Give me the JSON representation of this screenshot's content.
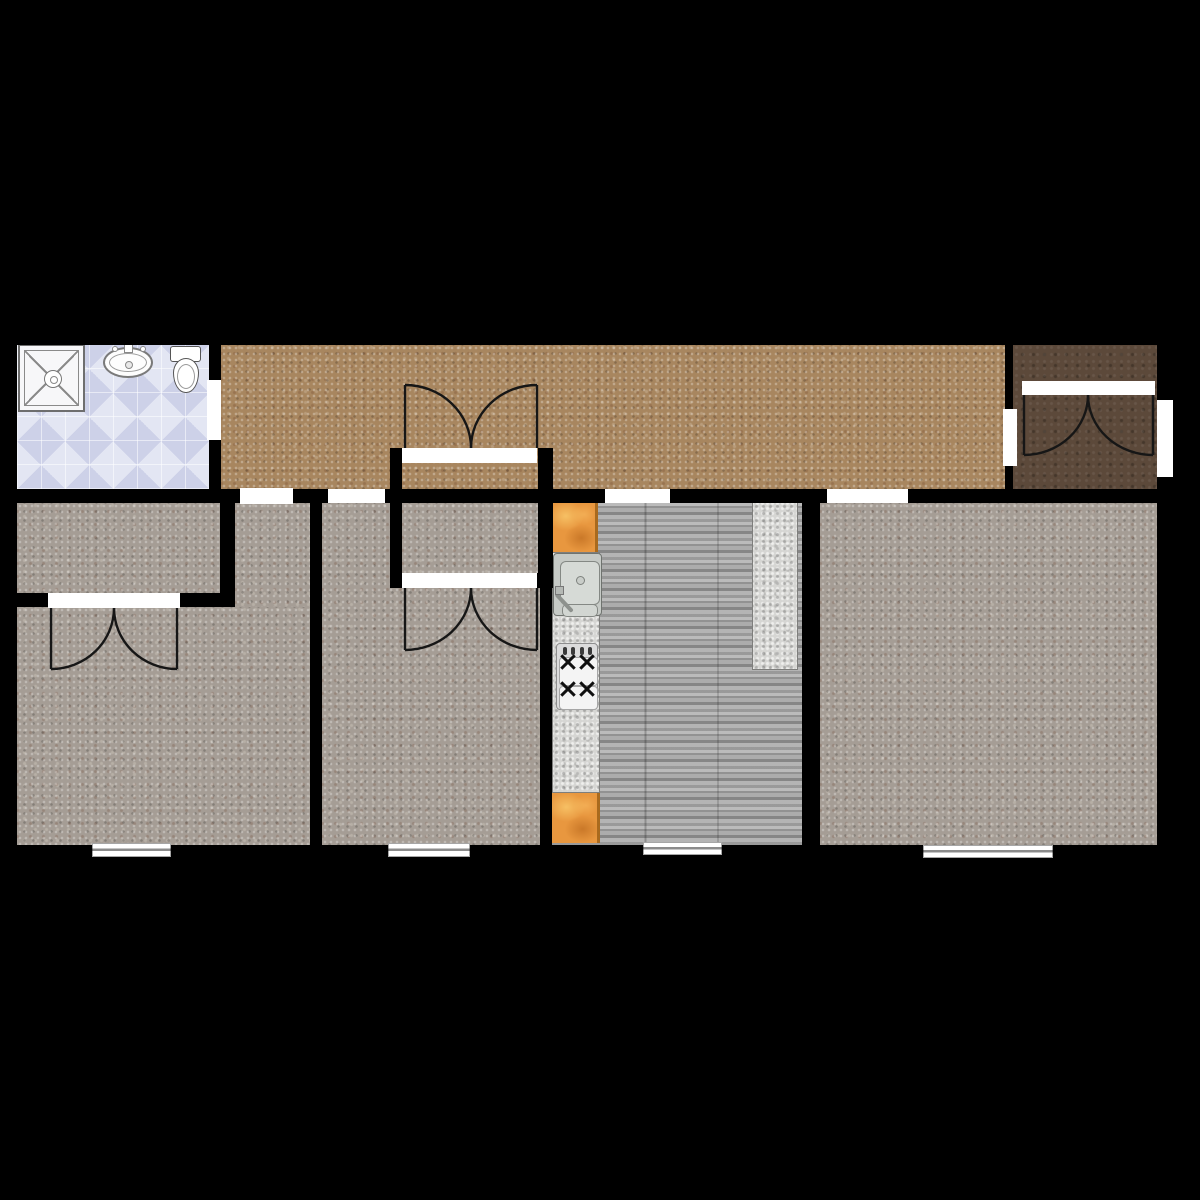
{
  "meta": {
    "canvas_width": 1200,
    "canvas_height": 1200,
    "background": "#000000",
    "kind": "residential-floor-plan"
  },
  "palette": {
    "wall": "#000000",
    "opening": "#ffffff",
    "carpet_brown": "#a8865f",
    "carpet_gray": "#a59d95",
    "carpet_dark_brown": "#5c493a",
    "bathroom_tile": "#d6daee",
    "kitchen_plank": "#a3a3a3",
    "granite": "#d6d6d3",
    "cutting_board": "#e8973f",
    "door_arc": "#161616"
  },
  "rooms": [
    {
      "name": "bathroom-floor",
      "tex": "tile",
      "color": "#d6daee",
      "rect": [
        17,
        345,
        192,
        144
      ]
    },
    {
      "name": "hallway-floor",
      "tex": "carpet",
      "color": "#a8865f",
      "rect": [
        221,
        345,
        784,
        144
      ]
    },
    {
      "name": "entry-room-floor",
      "tex": "dark",
      "color": "#5c493a",
      "rect": [
        1013,
        344,
        147,
        149
      ]
    },
    {
      "name": "left-closet-floor",
      "tex": "carpet",
      "color": "#a59d95",
      "rect": [
        17,
        503,
        203,
        90
      ]
    },
    {
      "name": "left-bedroom-alcove-floor",
      "tex": "carpet",
      "color": "#a59d95",
      "rect": [
        235,
        503,
        75,
        110
      ]
    },
    {
      "name": "left-bedroom-floor",
      "tex": "carpet",
      "color": "#a59d95",
      "rect": [
        17,
        607,
        293,
        238
      ]
    },
    {
      "name": "center-bedroom-floor",
      "tex": "carpet",
      "color": "#a59d95",
      "rect": [
        322,
        503,
        218,
        342
      ]
    },
    {
      "name": "hall-closet-floor",
      "tex": "carpet",
      "color": "#a59d95",
      "rect": [
        402,
        503,
        136,
        70
      ]
    },
    {
      "name": "kitchen-floor",
      "tex": "plank",
      "color": "#a3a3a3",
      "rect": [
        552,
        503,
        250,
        342
      ]
    },
    {
      "name": "living-room-floor",
      "tex": "carpet",
      "color": "#a59d95",
      "rect": [
        820,
        503,
        337,
        342
      ]
    }
  ],
  "walls": [
    {
      "name": "exterior-wall-top",
      "rect": [
        10,
        330,
        1162,
        15
      ]
    },
    {
      "name": "exterior-wall-left",
      "rect": [
        10,
        330,
        7,
        528
      ]
    },
    {
      "name": "exterior-wall-bottom",
      "rect": [
        10,
        845,
        1162,
        13
      ]
    },
    {
      "name": "exterior-wall-right",
      "rect": [
        1157,
        330,
        15,
        528
      ]
    },
    {
      "name": "hallway-south-wall",
      "rect": [
        15,
        489,
        1157,
        14
      ]
    },
    {
      "name": "bathroom-east-wall",
      "rect": [
        209,
        345,
        12,
        144
      ]
    },
    {
      "name": "entry-west-wall",
      "rect": [
        1005,
        344,
        8,
        146
      ]
    },
    {
      "name": "left-closet-east-wall",
      "rect": [
        220,
        503,
        15,
        104
      ]
    },
    {
      "name": "left-closet-south-wall",
      "rect": [
        15,
        593,
        220,
        14
      ]
    },
    {
      "name": "center-bedroom-west-wall",
      "rect": [
        310,
        503,
        12,
        342
      ]
    },
    {
      "name": "hall-closet-west-wall",
      "rect": [
        390,
        448,
        12,
        140
      ]
    },
    {
      "name": "hall-closet-east-wall",
      "rect": [
        538,
        448,
        15,
        140
      ]
    },
    {
      "name": "hall-closet-south-wall",
      "rect": [
        390,
        573,
        163,
        15
      ]
    },
    {
      "name": "kitchen-west-wall",
      "rect": [
        540,
        588,
        12,
        257
      ]
    },
    {
      "name": "kitchen-east-wall",
      "rect": [
        802,
        503,
        18,
        342
      ]
    }
  ],
  "openings": [
    {
      "name": "bathroom-door-opening",
      "rect": [
        207,
        380,
        14,
        60
      ]
    },
    {
      "name": "left-bedroom-opening",
      "rect": [
        240,
        488,
        53,
        16
      ]
    },
    {
      "name": "center-bedroom-opening",
      "rect": [
        328,
        489,
        57,
        14
      ]
    },
    {
      "name": "kitchen-opening",
      "rect": [
        605,
        489,
        65,
        14
      ]
    },
    {
      "name": "living-room-opening",
      "rect": [
        827,
        489,
        81,
        14
      ]
    },
    {
      "name": "entry-opening-west",
      "rect": [
        1003,
        409,
        14,
        57
      ]
    },
    {
      "name": "entry-exterior-door-opening",
      "rect": [
        1157,
        400,
        16,
        77
      ]
    },
    {
      "name": "hall-closet-north-doorway",
      "rect": [
        402,
        448,
        135,
        15
      ]
    },
    {
      "name": "hall-closet-south-doorway",
      "rect": [
        402,
        573,
        135,
        15
      ]
    },
    {
      "name": "left-closet-doorway",
      "rect": [
        48,
        593,
        132,
        15
      ]
    },
    {
      "name": "entry-closet-doorway",
      "rect": [
        1022,
        381,
        133,
        14
      ]
    }
  ],
  "windows": [
    {
      "name": "left-bedroom-window",
      "rect": [
        92,
        843,
        79,
        14
      ]
    },
    {
      "name": "center-bedroom-window",
      "rect": [
        388,
        843,
        82,
        14
      ]
    },
    {
      "name": "kitchen-window",
      "rect": [
        643,
        842,
        79,
        13
      ]
    },
    {
      "name": "living-room-window",
      "rect": [
        923,
        845,
        130,
        13
      ]
    }
  ],
  "doors": [
    {
      "name": "hall-closet-north-door-left",
      "path": "M405,385 L405,448 M471,448 A66,63 0 0 0 405,385"
    },
    {
      "name": "hall-closet-north-door-right",
      "path": "M537,385 L537,448 M471,448 A66,63 0 0 1 537,385"
    },
    {
      "name": "hall-closet-south-door-left",
      "path": "M405,650 L405,588 M471,588 A66,62 0 0 1 405,650"
    },
    {
      "name": "hall-closet-south-door-right",
      "path": "M537,650 L537,588 M471,588 A66,62 0 0 0 537,650"
    },
    {
      "name": "left-closet-door-left",
      "path": "M51,669 L51,608 M114,608 A63,61 0 0 1 51,669"
    },
    {
      "name": "left-closet-door-right",
      "path": "M177,669 L177,608 M114,608 A63,61 0 0 0 177,669"
    },
    {
      "name": "entry-closet-door-left",
      "path": "M1024,455 L1024,395 M1088,395 A64,60 0 0 1 1024,455"
    },
    {
      "name": "entry-closet-door-right",
      "path": "M1153,455 L1153,395 M1088,395 A65,60 0 0 0 1153,455"
    }
  ],
  "counters": [
    {
      "name": "kitchen-counter-granite",
      "tex": "granite",
      "color": "#d6d6d3",
      "rect": [
        552,
        552,
        48,
        241
      ]
    },
    {
      "name": "kitchen-side-counter",
      "tex": "granite",
      "color": "#d6d6d3",
      "rect": [
        752,
        502,
        46,
        168
      ]
    },
    {
      "name": "cutting-board-top",
      "tex": "board",
      "color": "#e8973f",
      "rect": [
        552,
        502,
        46,
        50
      ]
    },
    {
      "name": "cutting-board-bottom",
      "tex": "board",
      "color": "#e8973f",
      "rect": [
        552,
        793,
        48,
        50
      ]
    }
  ],
  "fixtures": {
    "shower": {
      "rect": [
        18,
        344,
        67,
        68
      ]
    },
    "bath_sink": {
      "bowl": [
        103,
        347,
        50,
        31
      ],
      "faucet": [
        124,
        343,
        9,
        10
      ],
      "handle_left": [
        112,
        346,
        6,
        6
      ],
      "handle_right": [
        140,
        346,
        6,
        6
      ]
    },
    "toilet": {
      "tank": [
        170,
        346,
        31,
        16
      ],
      "bowl": [
        173,
        358,
        26,
        35
      ]
    },
    "kitchen_sink": {
      "outer": [
        553,
        553,
        49,
        63
      ],
      "basin": [
        6,
        7,
        38,
        42
      ],
      "basin2": [
        8,
        50,
        34,
        11
      ],
      "drain": [
        22,
        22,
        7,
        7
      ],
      "faucet": [
        2,
        38,
        24,
        4
      ],
      "knob": [
        1,
        32,
        7,
        7
      ]
    },
    "stove": {
      "outer": [
        556,
        643,
        42,
        67
      ],
      "panels": [
        [
          2,
          13,
          37,
          27
        ],
        [
          2,
          42,
          37,
          22
        ]
      ],
      "burners": [
        [
          11,
          18
        ],
        [
          30,
          18
        ],
        [
          11,
          45
        ],
        [
          30,
          45
        ]
      ],
      "knobs": [
        [
          6,
          3
        ],
        [
          14,
          3
        ],
        [
          23,
          3
        ],
        [
          31,
          3
        ]
      ]
    }
  }
}
